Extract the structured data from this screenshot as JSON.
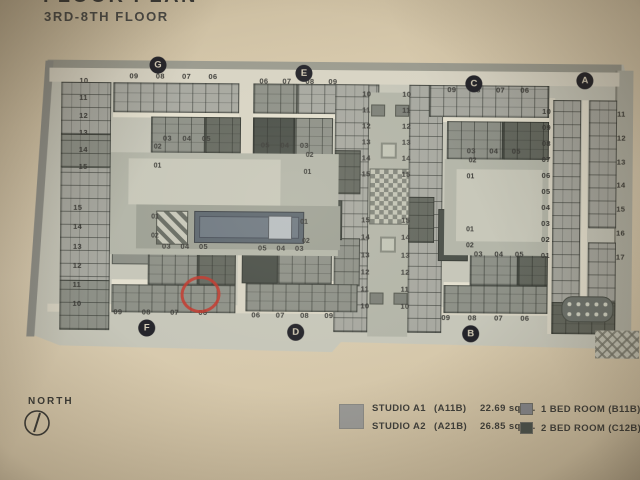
{
  "header": {
    "title_partial": "FLOOR PLAN",
    "subtitle": "3RD-8TH FLOOR"
  },
  "compass": {
    "label": "NORTH"
  },
  "plan": {
    "markers": {
      "g": "G",
      "e": "E",
      "c": "C",
      "a": "A",
      "f": "F",
      "d": "D",
      "b": "B"
    },
    "axis_left_top": [
      "10",
      "11",
      "12",
      "13",
      "14",
      "15"
    ],
    "axis_left_bottom": [
      "15",
      "14",
      "13",
      "12",
      "11",
      "10"
    ],
    "core_top": [
      "10",
      "11",
      "12",
      "13",
      "14",
      "15"
    ],
    "core_bottom": [
      "15",
      "14",
      "13",
      "12",
      "11",
      "10"
    ],
    "wing_g": {
      "top_row": [
        "09",
        "08",
        "07",
        "06"
      ],
      "unit_row": [
        "03",
        "04",
        "05"
      ],
      "unit_02": "02",
      "unit_01": "01"
    },
    "wing_e": {
      "top_row": [
        "06",
        "07",
        "08",
        "09"
      ],
      "unit_row": [
        "05",
        "04",
        "03"
      ],
      "unit_02": "02",
      "unit_01": "01"
    },
    "wing_c": {
      "top_row": [
        "09",
        "08",
        "07",
        "06"
      ],
      "unit_row": [
        "03",
        "04",
        "05"
      ],
      "unit_02": "02",
      "unit_01": "01"
    },
    "wing_a": {
      "col_left": [
        "10",
        "09",
        "08",
        "07",
        "06",
        "05",
        "04",
        "03",
        "02",
        "01"
      ],
      "col_right": [
        "11",
        "12",
        "13",
        "14",
        "15",
        "16",
        "17"
      ]
    },
    "wing_f": {
      "bottom_row": [
        "09",
        "08",
        "07",
        "06"
      ],
      "unit_01": "01",
      "unit_02": "02",
      "unit_row": [
        "03",
        "04",
        "05"
      ]
    },
    "wing_d": {
      "bottom_row": [
        "06",
        "07",
        "08",
        "09"
      ],
      "unit_01": "01",
      "unit_02": "02",
      "unit_row": [
        "05",
        "04",
        "03"
      ]
    },
    "wing_b": {
      "bottom_row": [
        "09",
        "08",
        "07",
        "06"
      ],
      "unit_01": "01",
      "unit_02": "02",
      "unit_row": [
        "03",
        "04",
        "05"
      ]
    },
    "annotation": {
      "shape": "red-circle",
      "marked_unit": "06",
      "color": "#c3372c"
    }
  },
  "legend": {
    "studio": {
      "swatch_color": "#9a9a97",
      "rows": [
        {
          "name": "STUDIO A1",
          "code": "(A11B)",
          "area": "22.69 sq.m."
        },
        {
          "name": "STUDIO A2",
          "code": "(A21B)",
          "area": "26.85 sq.m."
        }
      ]
    },
    "bedrooms": {
      "rows": [
        {
          "swatch_color": "#84868b",
          "name": "1 BED ROOM (B11B)",
          "area": "28.86"
        },
        {
          "swatch_color": "#4b524d",
          "name": "2 BED ROOM (C12B)",
          "area": "46.24"
        }
      ]
    }
  }
}
